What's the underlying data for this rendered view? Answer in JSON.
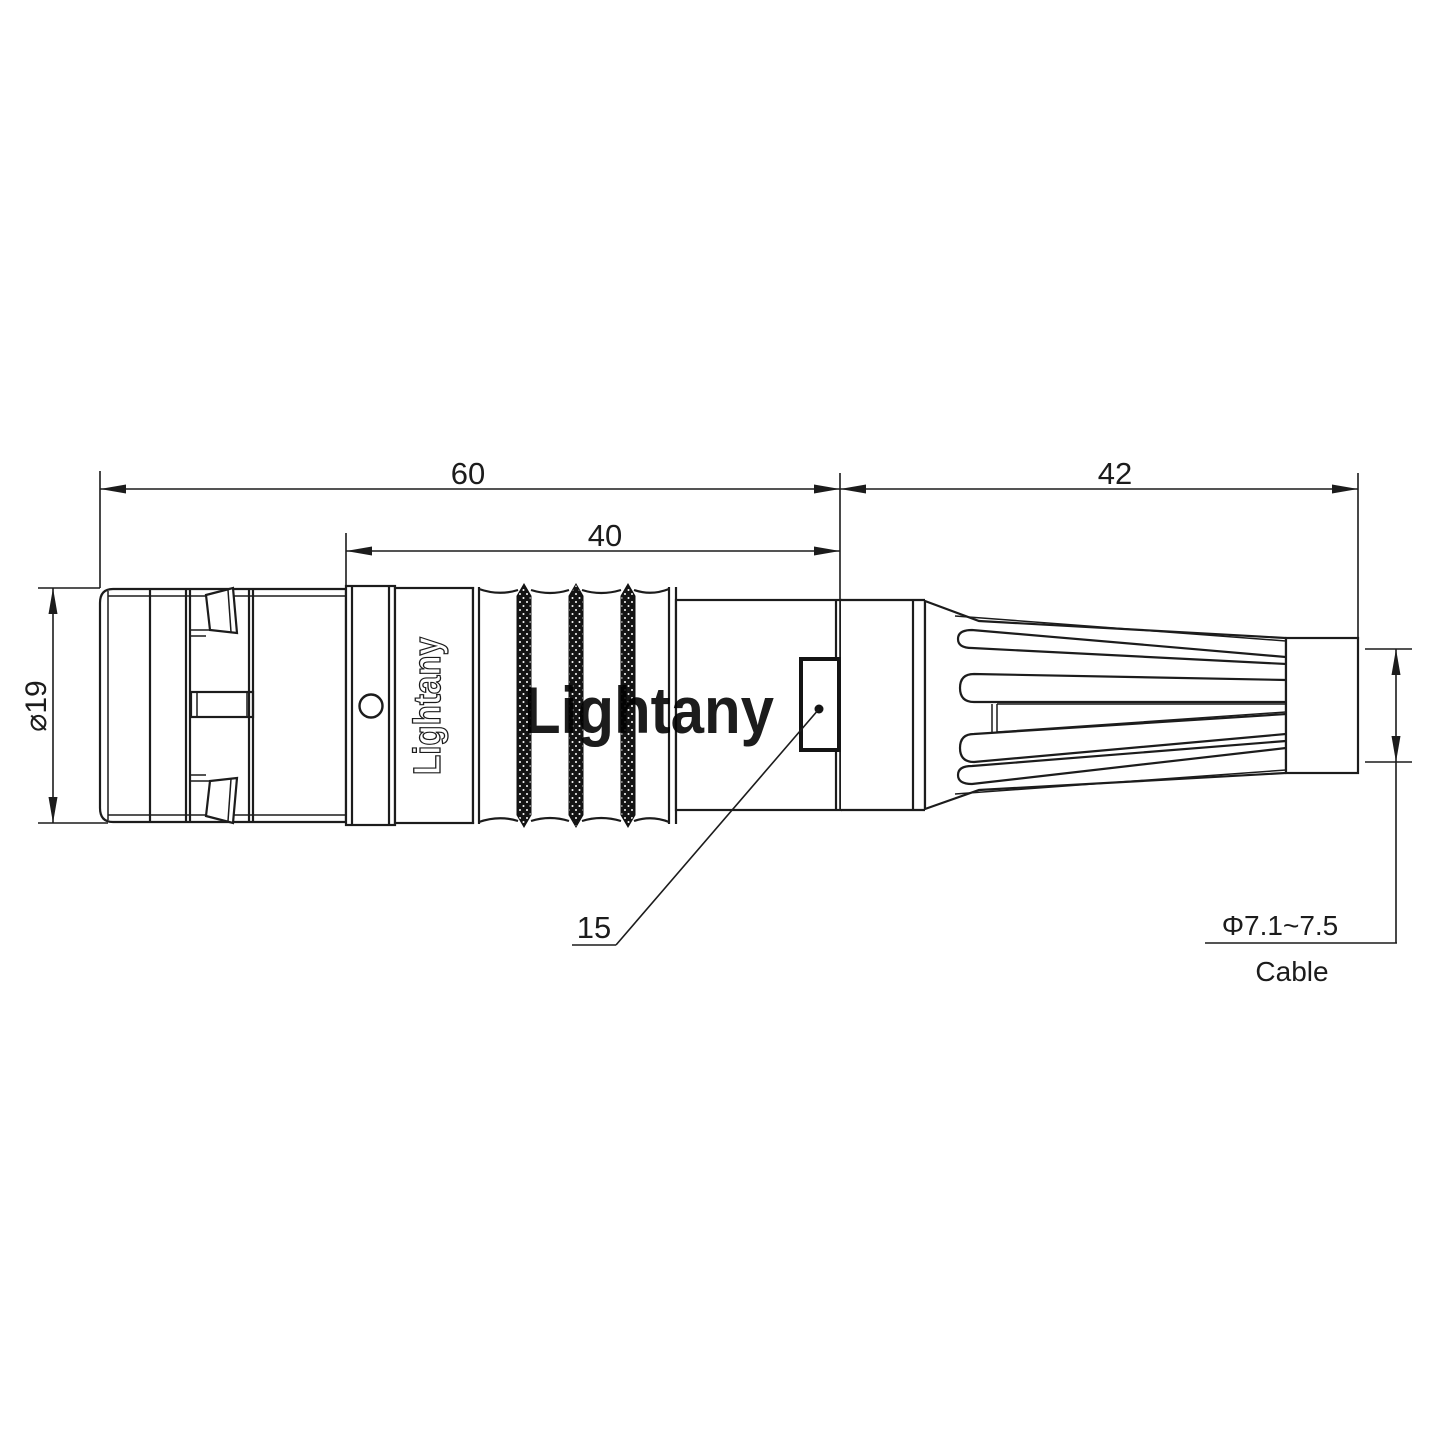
{
  "drawing": {
    "dimensions": {
      "overall_length": "60",
      "front_section_length": "40",
      "boot_length": "42",
      "body_diameter": "⌀19",
      "key_feature": "15",
      "cable_range": "Φ7.1~7.5",
      "cable_label": "Cable"
    },
    "branding": {
      "body_marking": "Lightany",
      "watermark": "Lightany"
    },
    "colors": {
      "line_color": "#1c1c1c",
      "watermark_color": "#f6ccc7"
    }
  }
}
